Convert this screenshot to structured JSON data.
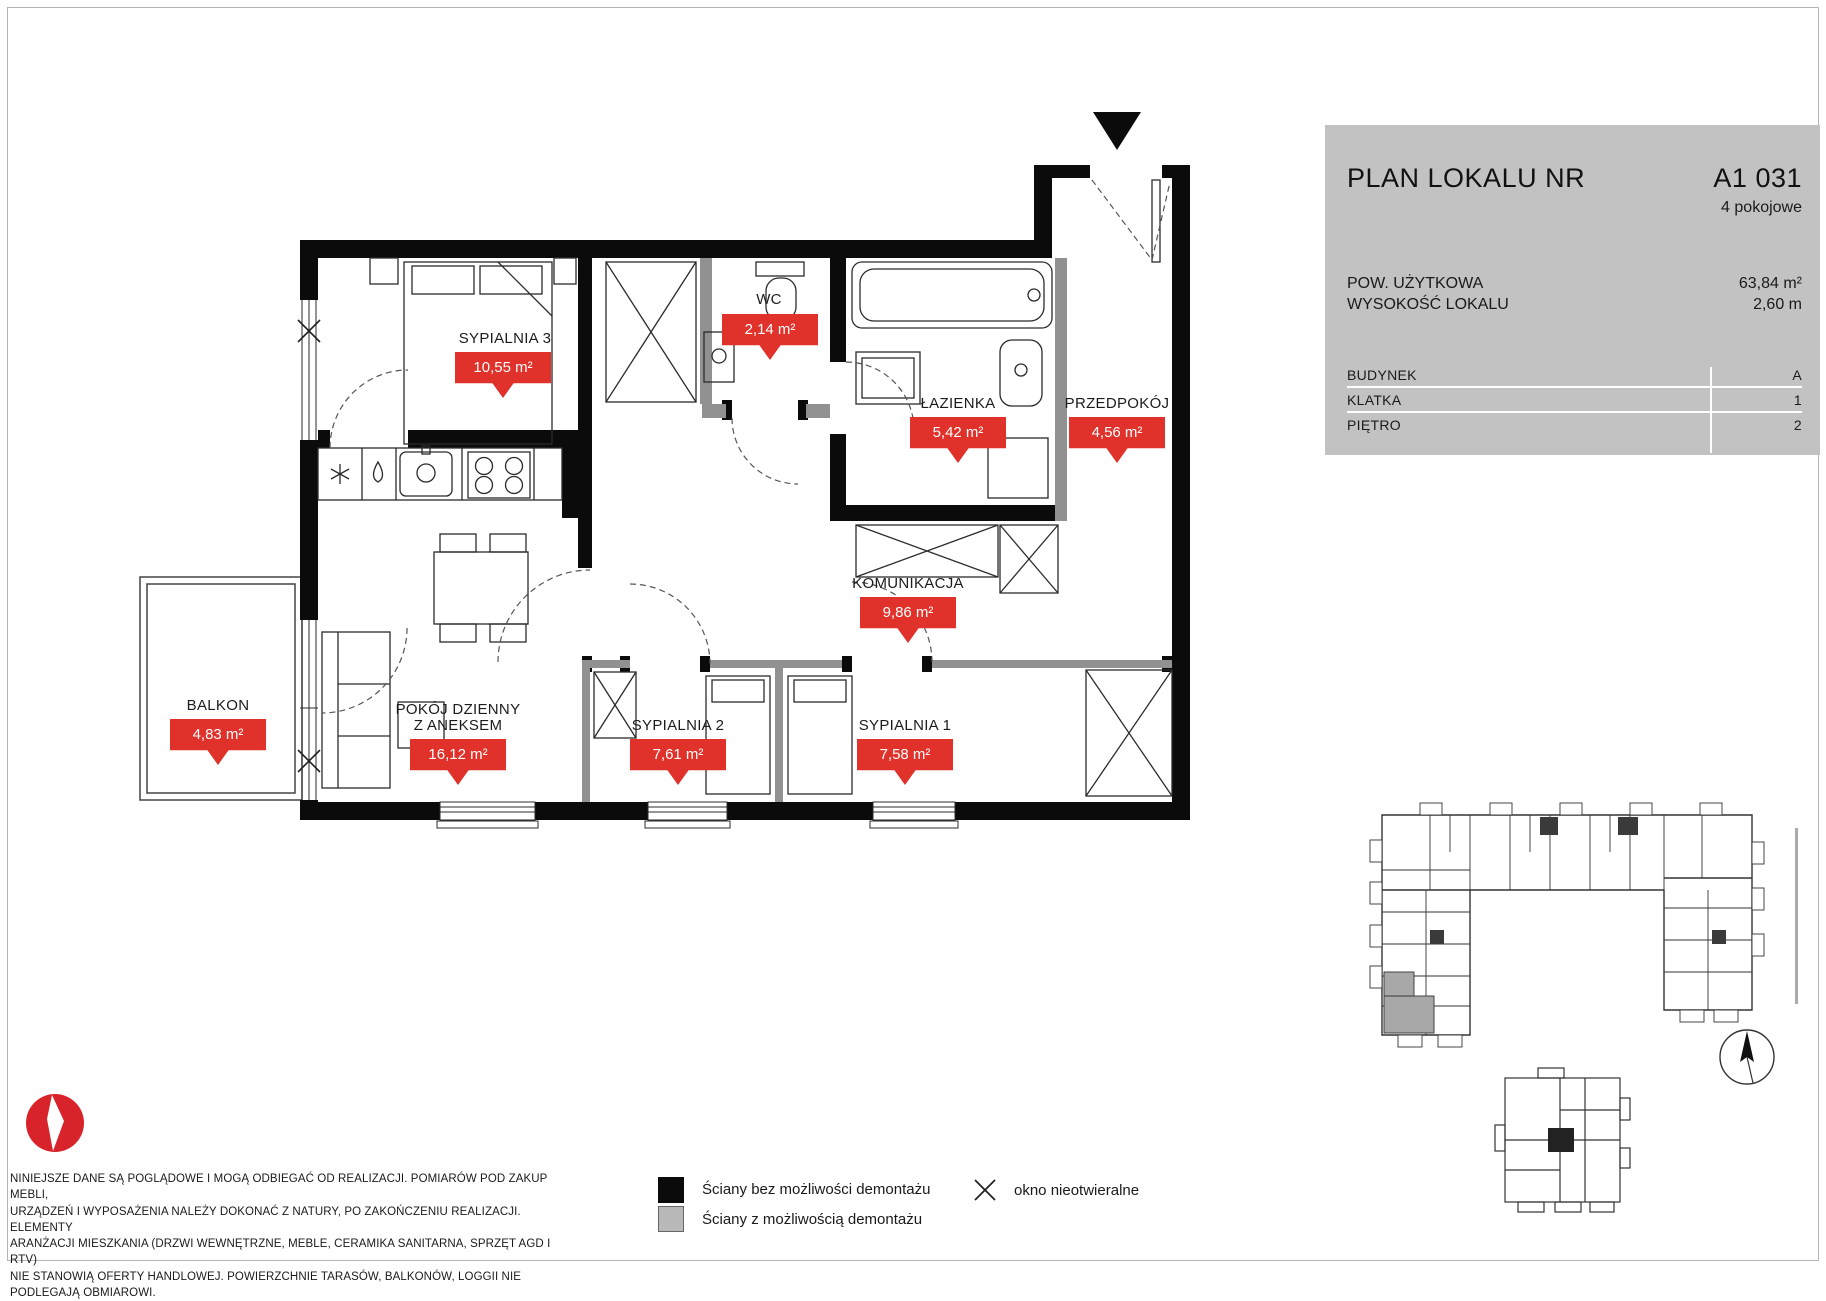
{
  "panel": {
    "title": "PLAN LOKALU NR",
    "unit_number": "A1 031",
    "unit_type": "4 pokojowe",
    "specs": [
      {
        "label": "POW. UŻYTKOWA",
        "value": "63,84 m²"
      },
      {
        "label": "WYSOKOŚĆ LOKALU",
        "value": "2,60 m"
      }
    ],
    "details": [
      {
        "label": "BUDYNEK",
        "value": "A"
      },
      {
        "label": "KLATKA",
        "value": "1"
      },
      {
        "label": "PIĘTRO",
        "value": "2"
      }
    ]
  },
  "rooms": {
    "sypialnia3": {
      "name": "SYPIALNIA 3",
      "area": "10,55 m²"
    },
    "wc": {
      "name": "WC",
      "area": "2,14 m²"
    },
    "lazienka": {
      "name": "ŁAZIENKA",
      "area": "5,42 m²"
    },
    "przedpokoj": {
      "name": "PRZEDPOKÓJ",
      "area": "4,56 m²"
    },
    "komunikacja": {
      "name": "KOMUNIKACJA",
      "area": "9,86 m²"
    },
    "pokoj_dzienny": {
      "name": "POKÓJ DZIENNY\nZ ANEKSEM",
      "area": "16,12 m²"
    },
    "sypialnia2": {
      "name": "SYPIALNIA 2",
      "area": "7,61 m²"
    },
    "sypialnia1": {
      "name": "SYPIALNIA 1",
      "area": "7,58 m²"
    },
    "balkon": {
      "name": "BALKON",
      "area": "4,83 m²"
    }
  },
  "legend": {
    "wall_solid": "Ściany bez możliwości demontażu",
    "wall_removable": "Ściany z możliwością demontażu",
    "window_fixed": "okno nieotwieralne"
  },
  "disclaimer": "NINIEJSZE DANE SĄ POGLĄDOWE I MOGĄ ODBIEGAĆ OD REALIZACJI. POMIARÓW POD ZAKUP MEBLI,\nURZĄDZEŃ I WYPOSAŻENIA NALEŻY DOKONAĆ Z NATURY, PO ZAKOŃCZENIU REALIZACJI. ELEMENTY\nARANŻACJI MIESZKANIA (DRZWI WEWNĘTRZNE, MEBLE, CERAMIKA SANITARNA, SPRZĘT AGD I RTV)\nNIE STANOWIĄ OFERTY HANDLOWEJ. POWIERZCHNIE TARASÓW, BALKONÓW, LOGGII NIE\nPODLEGAJĄ OBMIAROWI.",
  "colors": {
    "accent_red": "#e0312a",
    "panel_gray": "#c2c2c2",
    "wall_black": "#0b0b0b",
    "wall_gray": "#919191"
  }
}
